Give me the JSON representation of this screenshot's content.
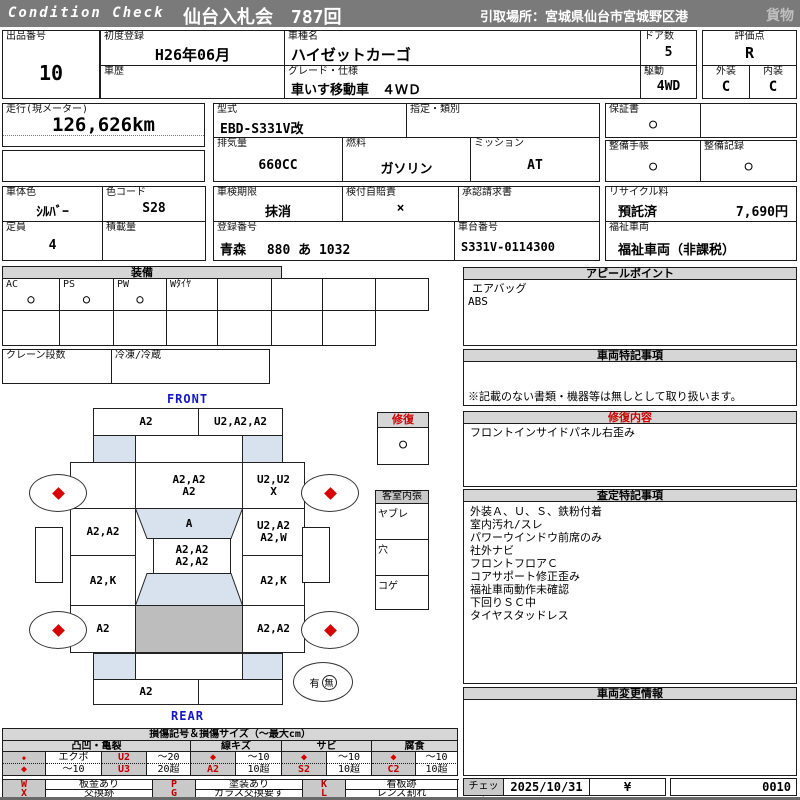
{
  "header": {
    "brand": "Condition  Check",
    "auction": "仙台入札会　787回",
    "pickup": "引取場所：宮城県仙台市宮城野区港",
    "category": "貨物"
  },
  "info": {
    "lot_label": "出品番号",
    "lot": "10",
    "first_reg_label": "初度登録",
    "first_reg": "H26年06月",
    "history_label": "車歴",
    "history": "",
    "model_label": "車種名",
    "model": "ハイゼットカーゴ",
    "grade_label": "グレード・仕様",
    "grade": "車いす移動車　４ＷＤ",
    "doors_label": "ドア数",
    "doors": "5",
    "drive_label": "駆動",
    "drive": "4WD",
    "score_label": "評価点",
    "score": "R",
    "exterior_label": "外装",
    "exterior": "C",
    "interior_label": "内装",
    "interior": "C",
    "mileage_label": "走行(現メーター)",
    "mileage": "126,626km",
    "model_code_label": "型式",
    "model_code": "EBD-S331V改",
    "class_label": "指定・類別",
    "class": "",
    "displacement_label": "排気量",
    "displacement": "660CC",
    "fuel_label": "燃料",
    "fuel": "ガソリン",
    "transmission_label": "ミッション",
    "transmission": "AT",
    "warranty_label": "保証書",
    "warranty": "○",
    "service_book_label": "整備手帳",
    "service_book": "○",
    "service_record_label": "整備記録",
    "service_record": "○",
    "body_color_label": "車体色",
    "body_color": "ｼﾙﾊﾞｰ",
    "color_code_label": "色コード",
    "color_code": "S28",
    "shaken_label": "車検期限",
    "shaken": "抹消",
    "insurance_label": "検付自賠責",
    "insurance": "×",
    "approval_label": "承認請求書",
    "approval": "",
    "recycle_label": "リサイクル料",
    "recycle_status": "預託済",
    "recycle_fee": "7,690円",
    "capacity_label": "定員",
    "capacity": "4",
    "load_label": "積載量",
    "load": "",
    "reg_no_label": "登録番号",
    "reg_no": "青森　 880 あ 1032",
    "chassis_label": "車台番号",
    "chassis": "S331V-0114300",
    "welfare_label": "福祉車両",
    "welfare": "福祉車両（非課税）"
  },
  "equipment": {
    "title": "装備",
    "items": [
      {
        "label": "AC",
        "value": "○"
      },
      {
        "label": "PS",
        "value": "○"
      },
      {
        "label": "PW",
        "value": "○"
      },
      {
        "label": "Wﾀｲﾔ",
        "value": ""
      }
    ],
    "crane_label": "クレーン段数",
    "fridge_label": "冷凍/冷蔵"
  },
  "appeal": {
    "title": "アピールポイント",
    "lines": [
      "エアバッグ",
      "ABS"
    ]
  },
  "special_notes": {
    "title": "車両特記事項",
    "footnote": "※記載のない書類・機器等は無しとして取り扱います。"
  },
  "repair_info": {
    "title": "修復内容",
    "lines": [
      "フロントインサイドパネル右歪み"
    ]
  },
  "assessment": {
    "title": "査定特記事項",
    "lines": [
      "外装Ａ、Ｕ、Ｓ、鉄粉付着",
      "室内汚れ/スレ",
      "パワーウインドウ前席のみ",
      "社外ナビ",
      "フロントフロアＣ",
      "コアサポート修正歪み",
      "福祉車両動作未確認",
      "下回りＳＣ中",
      "タイヤスタッドレス"
    ]
  },
  "change_info": {
    "title": "車両変更情報"
  },
  "check_row": {
    "label": "チェック",
    "date": "2025/10/31",
    "mark": "¥",
    "code": "0010"
  },
  "diagram": {
    "front_label": "FRONT",
    "rear_label": "REAR",
    "repair_box": {
      "title": "修復",
      "value": "○"
    },
    "interior_box": {
      "title": "客室内張",
      "rows": [
        "ヤブレ",
        "穴",
        "コゲ"
      ]
    },
    "spare": {
      "present": "有",
      "absent": "無"
    },
    "cells": {
      "front_bumper_left": "A2",
      "front_bumper_right": "U2,A2,A2",
      "hood": "A2,A2\nA2",
      "front_fender_right": "U2,U2\nX",
      "door_left": "A2,A2",
      "windshield": "A",
      "door_right": "U2,A2\nA2,W",
      "roof": "A2,A2\nA2,A2",
      "quarter_left": "A2,K",
      "quarter_right": "A2,K",
      "rear_left": "A2",
      "rear_right": "A2,A2",
      "rear_bumper_left": "A2",
      "rear_bumper_right": ""
    }
  },
  "legend": {
    "title": "損傷記号＆損傷サイズ（～最大cm）",
    "groups": [
      {
        "name": "凸凹・亀裂",
        "rows": [
          [
            "◆",
            "エクボ",
            "U2",
            "～20"
          ],
          [
            "◆",
            "～10",
            "U3",
            "20超"
          ]
        ]
      },
      {
        "name": "線キズ",
        "rows": [
          [
            "◆",
            "～10"
          ],
          [
            "A2",
            "10超"
          ]
        ]
      },
      {
        "name": "サビ",
        "rows": [
          [
            "◆",
            "～10"
          ],
          [
            "S2",
            "10超"
          ]
        ]
      },
      {
        "name": "腐食",
        "rows": [
          [
            "◆",
            "～10"
          ],
          [
            "C2",
            "10超"
          ]
        ]
      }
    ],
    "codes": [
      [
        {
          "sym": "W",
          "desc": "板金あり"
        },
        {
          "sym": "P",
          "desc": "塗装あり"
        },
        {
          "sym": "K",
          "desc": "看板跡"
        }
      ],
      [
        {
          "sym": "X",
          "desc": "交換跡"
        },
        {
          "sym": "G",
          "desc": "ガラス交換要す"
        },
        {
          "sym": "L",
          "desc": "レンズ割れ"
        }
      ]
    ]
  },
  "colors": {
    "accent_red": "#cc0000",
    "label_blue": "#1515c8",
    "panel_blue": "#d8e2ee",
    "cargo_gray": "#bdbdbd",
    "bar_gray": "#7a7a7a"
  }
}
